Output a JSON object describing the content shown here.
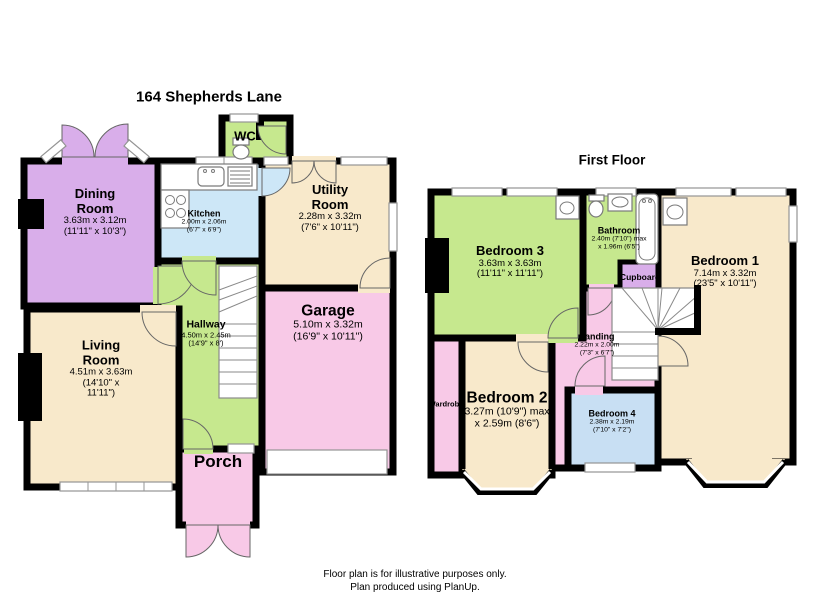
{
  "colors": {
    "wall": "#000000",
    "lilac": "#d9aeea",
    "green": "#c6e88e",
    "blue": "#cde7f7",
    "cream": "#f8e9cb",
    "pink": "#f8c9e7",
    "blue_light": "#c8dff3",
    "window": "#ffffff"
  },
  "ground": {
    "title": "164 Shepherds Lane",
    "rooms": {
      "dining": {
        "name": "Dining Room",
        "dims_m": "3.63m x 3.12m",
        "dims_ft": "(11'11\" x 10'3\")"
      },
      "kitchen": {
        "name": "Kitchen",
        "dims_m": "2.00m x 2.06m",
        "dims_ft": "(6'7\" x 6'9\")"
      },
      "wc": {
        "name": "WC"
      },
      "utility": {
        "name": "Utility Room",
        "dims_m": "2.28m x 3.32m",
        "dims_ft": "(7'6\" x 10'11\")"
      },
      "garage": {
        "name": "Garage",
        "dims_m": "5.10m x 3.32m",
        "dims_ft": "(16'9\" x 10'11\")"
      },
      "hallway": {
        "name": "Hallway",
        "dims_m": "4.50m x 2.45m",
        "dims_ft": "(14'9\" x 8')"
      },
      "living": {
        "name": "Living Room",
        "dims_m": "4.51m x 3.63m",
        "dims_ft": "(14'10\" x 11'11\")"
      },
      "porch": {
        "name": "Porch"
      }
    }
  },
  "first": {
    "title": "First Floor",
    "rooms": {
      "bedroom3": {
        "name": "Bedroom 3",
        "dims_m": "3.63m x 3.63m",
        "dims_ft": "(11'11\" x 11'11\")"
      },
      "bathroom": {
        "name": "Bathroom",
        "dims_m": "2.40m (7'10\") max",
        "dims_ft": "x 1.96m (6'5\")"
      },
      "cupboard": {
        "name": "Cupboard"
      },
      "bedroom1": {
        "name": "Bedroom 1",
        "dims_m": "7.14m x 3.32m",
        "dims_ft": "(23'5\" x 10'11\")"
      },
      "landing": {
        "name": "Landing",
        "dims_m": "2.22m x 2.00m",
        "dims_ft": "(7'3\" x 6'7\")"
      },
      "bedroom2": {
        "name": "Bedroom 2",
        "dims_m": "3.27m (10'9\") max",
        "dims_ft": "x 2.59m (8'6\")"
      },
      "bedroom4": {
        "name": "Bedroom 4",
        "dims_m": "2.38m x 2.19m",
        "dims_ft": "(7'10\" x 7'2\")"
      },
      "wardrobe": {
        "name": "Wardrobe"
      }
    }
  },
  "footer": {
    "line1": "Floor plan is for illustrative purposes only.",
    "line2": "Plan produced using PlanUp."
  }
}
